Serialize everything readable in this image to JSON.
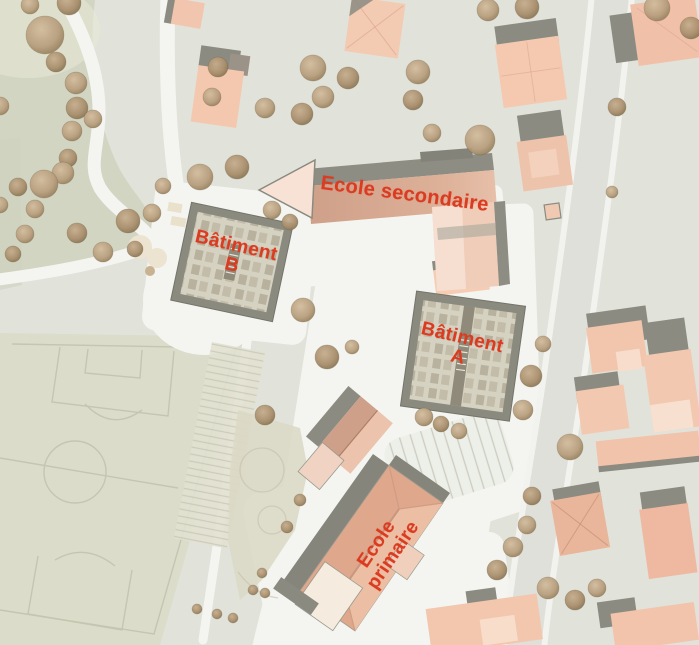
{
  "map": {
    "labels": {
      "ecole_secondaire": "Ecole secondaire",
      "batiment_b": "Bâtiment\nB",
      "batiment_a": "Bâtiment\nA",
      "ecole_primaire": "Ecole\nprimaire"
    },
    "colors": {
      "label_red": "#db3b20",
      "roof_salmon": "#f2c6ae",
      "roof_dark_gray": "#8b8b81",
      "flat_roof_gray": "#d6d2c2",
      "park_green": "#d3d5c3",
      "field_green": "#dbdcc9",
      "path_white": "#f4f5f0",
      "tree_tan": "#c0a888",
      "road_gray": "#dee0d9"
    }
  }
}
